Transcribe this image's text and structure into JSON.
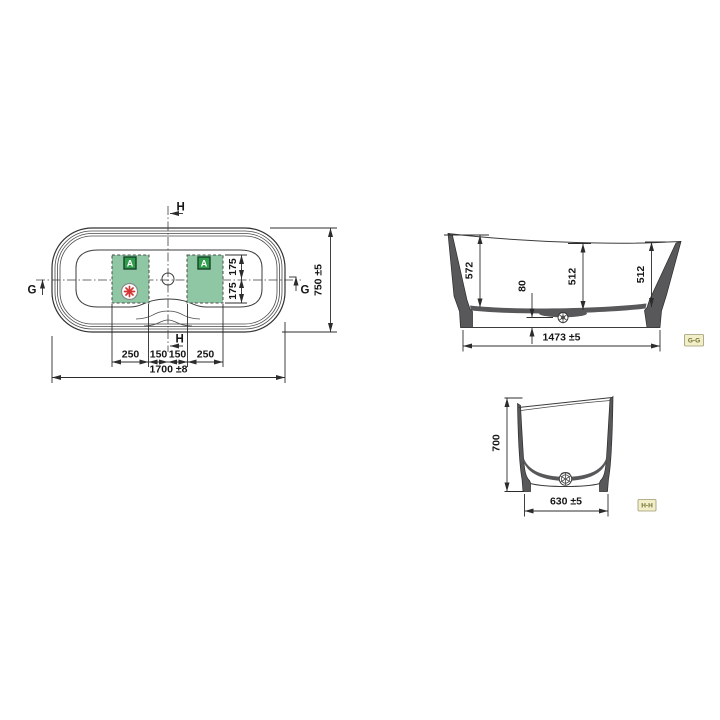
{
  "top_view": {
    "marker_h": "H",
    "marker_g": "G",
    "area_badge": "A",
    "dim_overall_length": "1700 ±8",
    "dim_overall_width": "750 ±5",
    "dim_chain": [
      "250",
      "150",
      "150",
      "250"
    ],
    "dim_offsets": [
      "175",
      "175"
    ]
  },
  "section_gg": {
    "tag": "G-G",
    "dim_depth_left": "572",
    "dim_depth_mid": "512",
    "dim_depth_right": "512",
    "dim_drain_height": "80",
    "dim_length": "1473 ±5"
  },
  "section_hh": {
    "tag": "H-H",
    "dim_height": "700",
    "dim_width": "630 ±5"
  },
  "icons": {
    "area_badge_icon": "A",
    "asterisk_icon": "eight-spoke-asterisk",
    "drain_icon": "drain-circle"
  },
  "colors": {
    "area_green": "#8fc7a5",
    "badge_green": "#2f9d4b",
    "asterisk_red": "#d63333",
    "tag_background": "#f2eeca",
    "wall_fill": "#58585b",
    "line": "#3c3c3c"
  }
}
